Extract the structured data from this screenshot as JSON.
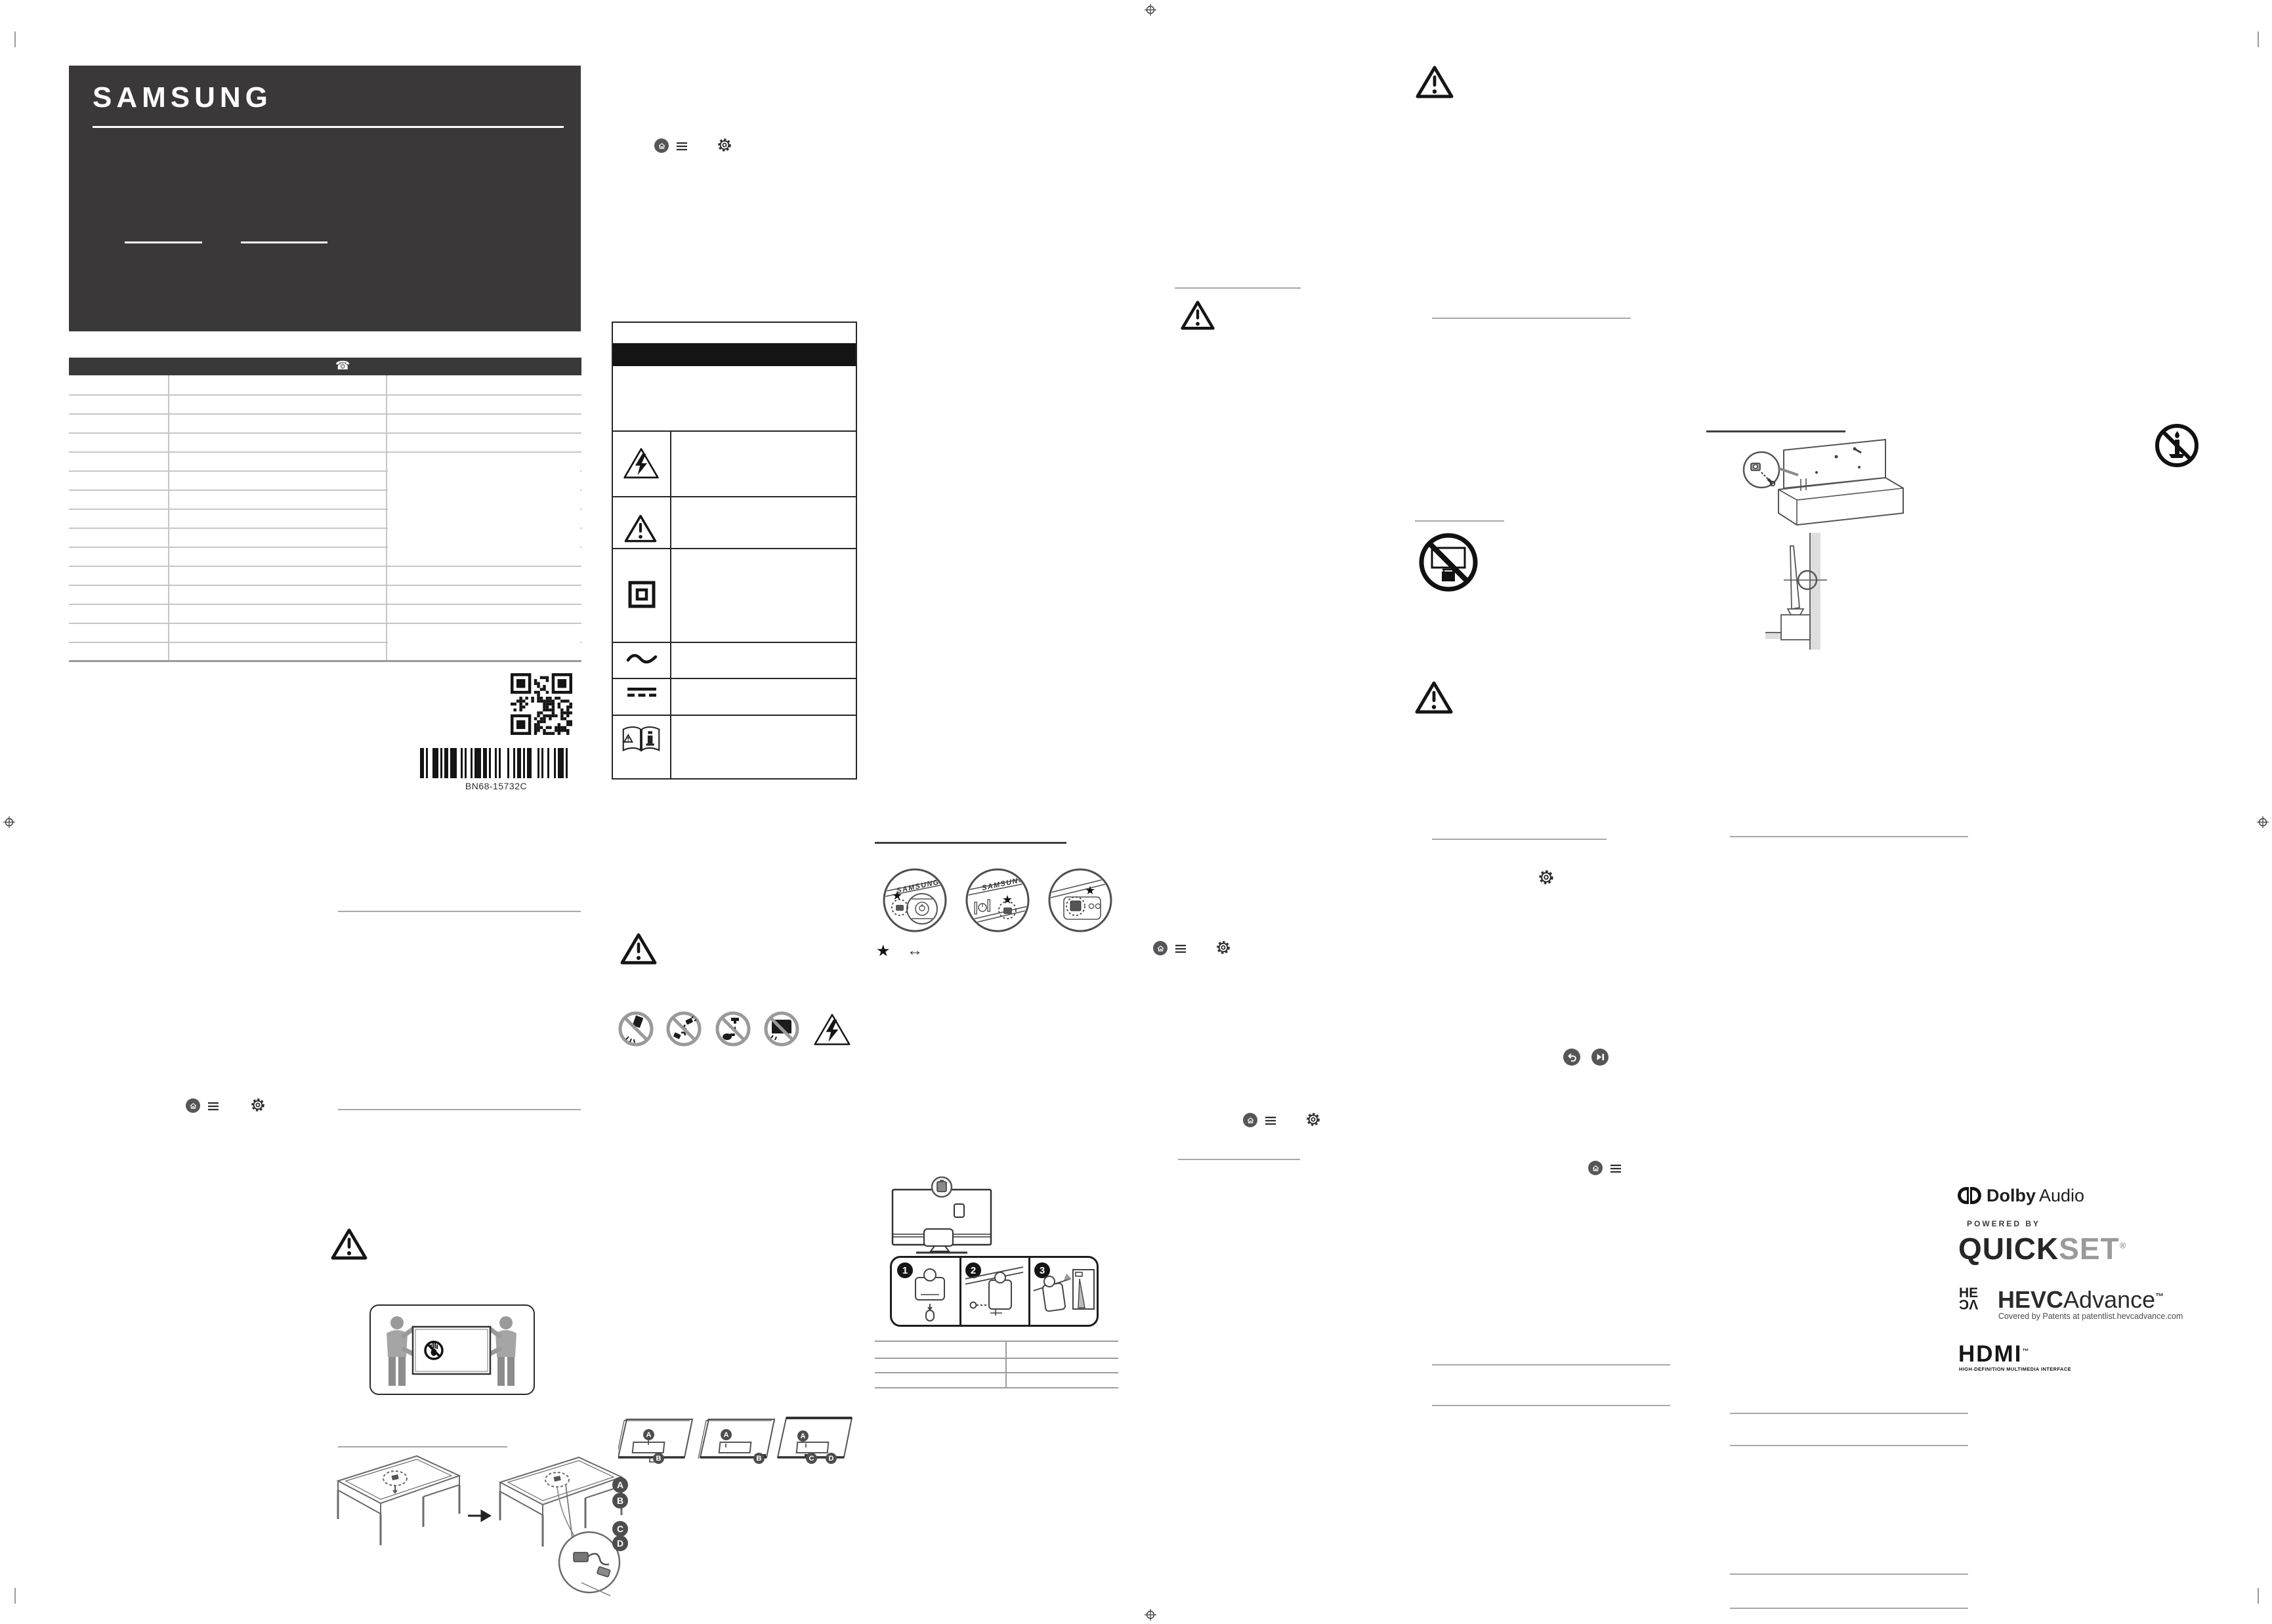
{
  "brand": {
    "wordmark": "SAMSUNG"
  },
  "contact_table": {
    "phone_icon_glyph": "☎"
  },
  "codes": {
    "part_number": "BN68-15732C"
  },
  "controller": {
    "brand": "SAMSUNG",
    "star": "★",
    "arrows": "↔"
  },
  "assembly_steps": [
    "1",
    "2",
    "3"
  ],
  "ports": {
    "a": "A",
    "b": "B",
    "c": "C",
    "d": "D"
  },
  "logos": {
    "dolby_word": "Dolby",
    "dolby_suffix": "Audio",
    "powered_by": "POWERED BY",
    "quickset_1": "QUICK",
    "quickset_2": "SET",
    "reg": "®",
    "tm": "™",
    "hevc_stack_1": "HE",
    "hevc_stack_2": "VC",
    "hevc_word_1": "HEVC",
    "hevc_word_2": "Advance",
    "hevc_caption": "Covered by Patents at patentlist.hevcadvance.com",
    "hdmi_word": "HDMI",
    "hdmi_caption": "HIGH-DEFINITION MULTIMEDIA INTERFACE"
  }
}
